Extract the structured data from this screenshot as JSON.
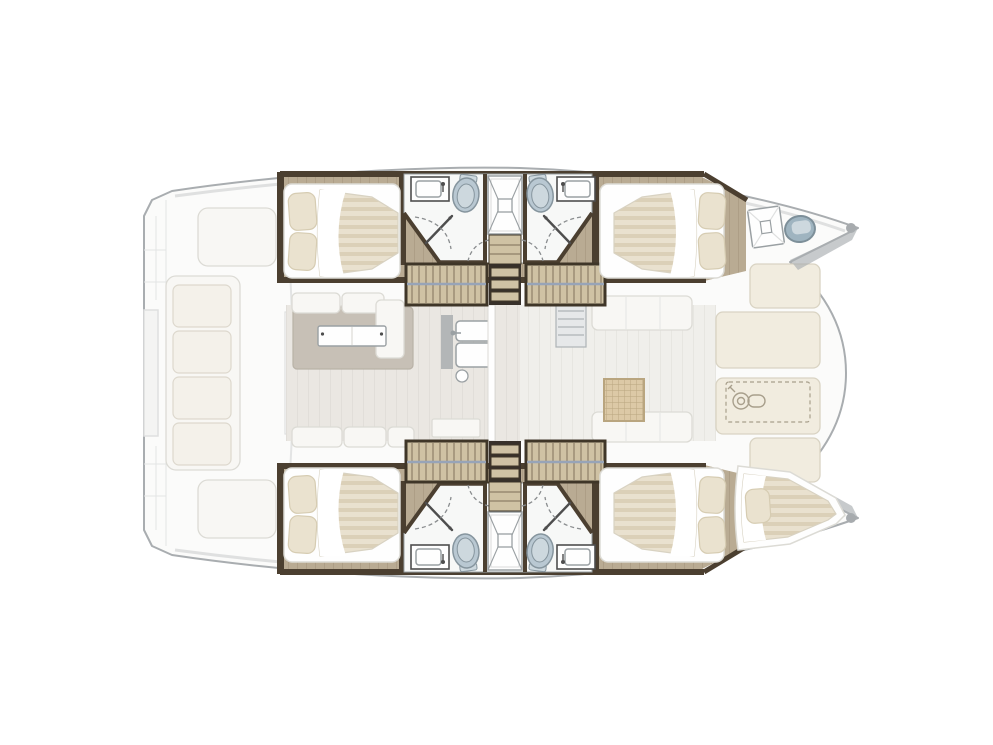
{
  "canvas": {
    "width": 993,
    "height": 745,
    "background": "#ffffff"
  },
  "scene": {
    "type": "yacht-floor-plan",
    "subject": "Interior layout plan of a 4-cabin sailing catamaran, top view, bow pointing right",
    "areas": {
      "aft_cockpit": {
        "features": [
          "bench seat with four cushions",
          "two sun pads",
          "transom steps on both hulls",
          "sliding door to saloon"
        ]
      },
      "saloon": {
        "features": [
          "L-shaped sofa",
          "rectangular table with two leaves on a rug",
          "galley counter with double sink and faucet",
          "low cabinet",
          "structural pillar"
        ]
      },
      "forward_cockpit": {
        "features": [
          "two bench seats",
          "rattan-top table",
          "ribbed appliance module"
        ]
      },
      "foredeck": {
        "features": [
          "four cream sun-pad panels",
          "anchor windlass locker marked with dashed outline"
        ]
      },
      "port_hull": {
        "aft_cabin": {
          "bed": "double berth, two pillows toward stern"
        },
        "bathroom": {
          "fixtures": [
            "washbasin",
            "toilet",
            "central shower with X floor pattern",
            "toilet",
            "washbasin"
          ],
          "doors": 2
        },
        "companionway": {
          "stair_flights": 2,
          "landing_steps": 3
        },
        "forward_cabin": {
          "bed": "double berth, two pillows toward bow"
        },
        "bow": {
          "features": [
            "crossed deck hatch",
            "blue-grey portlight fixture"
          ]
        }
      },
      "starboard_hull": {
        "aft_cabin": {
          "bed": "double berth, two pillows toward stern"
        },
        "bathroom": {
          "fixtures": [
            "washbasin",
            "toilet",
            "central shower with X floor pattern",
            "toilet",
            "washbasin"
          ],
          "doors": 2
        },
        "companionway": {
          "stair_flights": 2,
          "landing_steps": 3
        },
        "forward_cabin": {
          "bed": "double berth, two pillows toward bow"
        },
        "bow": {
          "features": [
            "single forepeak berth with one pillow"
          ]
        }
      }
    },
    "counts": {
      "double_berths": 4,
      "forepeak_berths": 1,
      "toilets": 4,
      "showers": 2,
      "washbasins": 4,
      "stair_flights": 4,
      "galley_sinks": 2
    }
  },
  "colors": {
    "outline": "#a9adb0",
    "outlineSoft": "#dfe0e0",
    "shadowLine": "#e3e4e4",
    "deck": "#fbfbfa",
    "panel": "#f4f4f3",
    "white": "#fefefe",
    "wood": "#b9ab93",
    "woodLine": "#a3947b",
    "woodLight": "#cfc2a4",
    "woodTrim": "#7c6f58",
    "woodDark": "#4b3f30",
    "stairFrame": "#3f3628",
    "stairWell": "#38312a",
    "stairRail": "#97a4b8",
    "matt": "#e9e1cf",
    "mattStripe": "#dbd0b8",
    "mattEdge": "#d8d2c2",
    "sheet": "#ffffff",
    "pillow": "#eae2cf",
    "pillowEdge": "#d6ccb2",
    "bathFloor": "#f7f8f7",
    "fixtureLine": "#9aa0a3",
    "toilet": "#b9c8d2",
    "toiletInner": "#cdd8de",
    "toiletEdge": "#86959e",
    "doorDark": "#4e4e4e",
    "dash": "#8a8d8f",
    "rug": "#c7c0b6",
    "rugEdge": "#b9b2a7",
    "saloonFloor": "#eae7e2",
    "fwdFloor": "#f0efeb",
    "furnWhite": "#f8f7f4",
    "furnEdge": "#dcdbd5",
    "cushion": "#f4f1ea",
    "cushionEdge": "#ddd8cd",
    "cream": "#f1ecdf",
    "creamEdge": "#d9d3c3",
    "counterGray": "#b3b6b7",
    "moduleGray": "#e6e8e9",
    "moduleEdge": "#aeb3b6",
    "glassBlue": "#9fb4c0",
    "glassEdge": "#7d8f99",
    "windlass": "#a89f8c",
    "rattan": "#dcc9a6",
    "rattanLine": "#b9a57f",
    "bowCap": "#a7abae"
  }
}
